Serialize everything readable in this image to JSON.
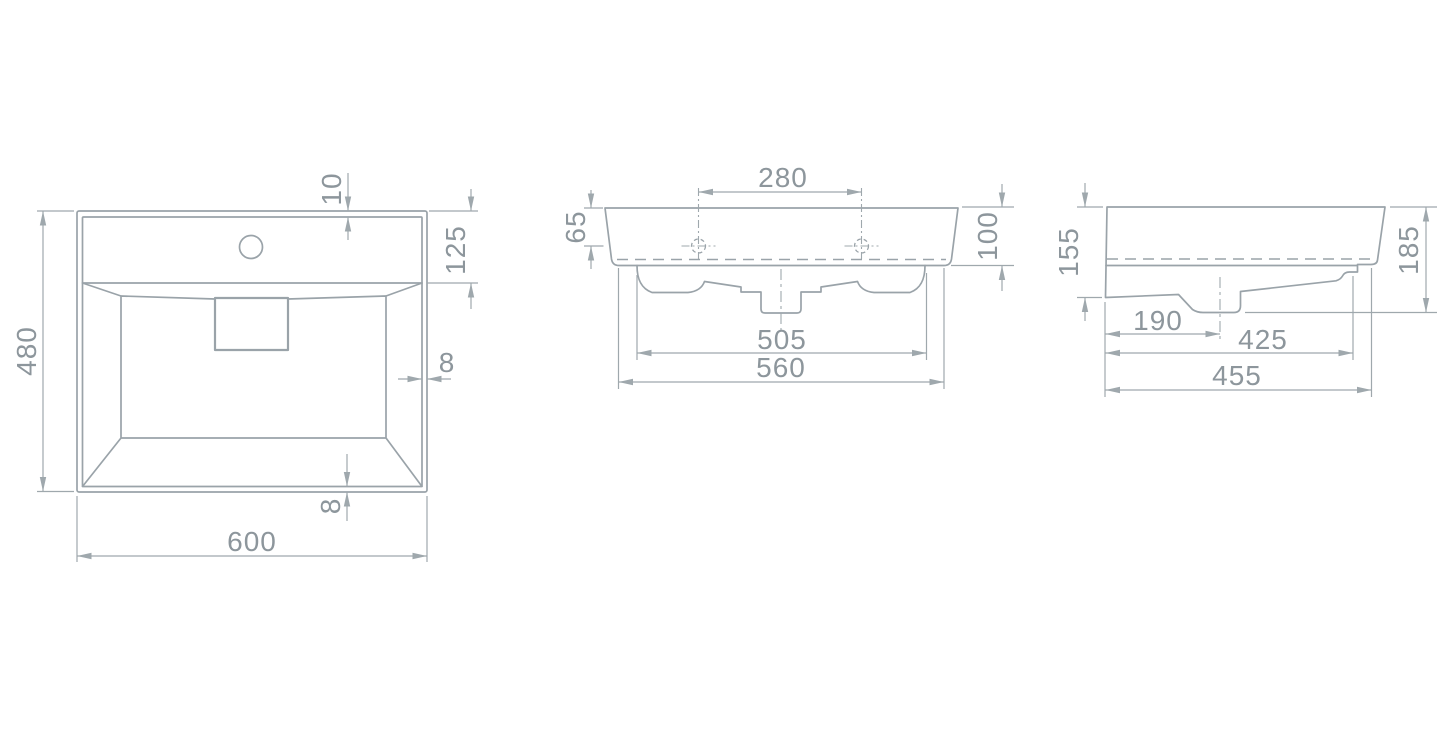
{
  "drawing": {
    "colors": {
      "line": "#9aa3a9",
      "dim": "#9fa8ad",
      "text": "#8d969c",
      "background": "#ffffff"
    },
    "views": {
      "plan": {
        "width": "600",
        "height": "480",
        "rim_top": "10",
        "deck_depth": "125",
        "rim_side": "8",
        "rim_bottom": "8"
      },
      "front": {
        "hole_spacing": "280",
        "top_to_hole": "65",
        "height": "100",
        "bowl_width": "505",
        "base_width": "560"
      },
      "side": {
        "front_height": "155",
        "overall_height": "185",
        "drain_offset": "190",
        "inner_depth": "425",
        "base_depth": "455"
      }
    }
  }
}
